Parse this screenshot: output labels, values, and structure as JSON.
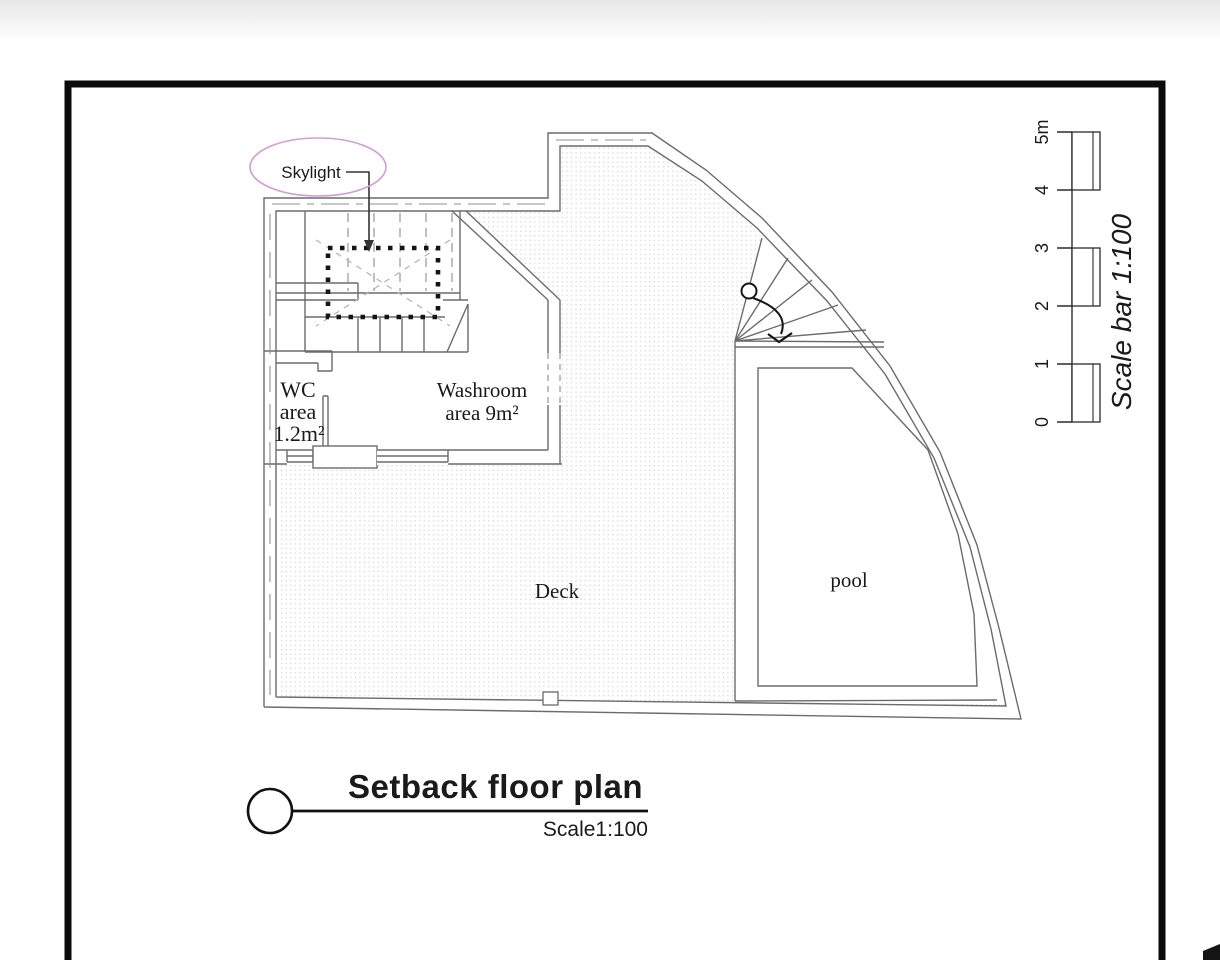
{
  "plan": {
    "labels": {
      "skylight": "Skylight",
      "wc_line1": "WC",
      "wc_line2": "area",
      "wc_line3": "1.2m²",
      "washroom_line1": "Washroom",
      "washroom_line2": "area 9m²",
      "deck": "Deck",
      "pool": "pool"
    },
    "annotation_color": "#d49ad8",
    "wall_color": "#6b6b6b",
    "skylight_marker_color": "#151515"
  },
  "scale_bar": {
    "title": "Scale bar 1:100",
    "ticks": [
      "0",
      "1",
      "2",
      "3",
      "4",
      "5m"
    ]
  },
  "title_block": {
    "title": "Setback floor plan",
    "scale": "Scale1:100"
  }
}
